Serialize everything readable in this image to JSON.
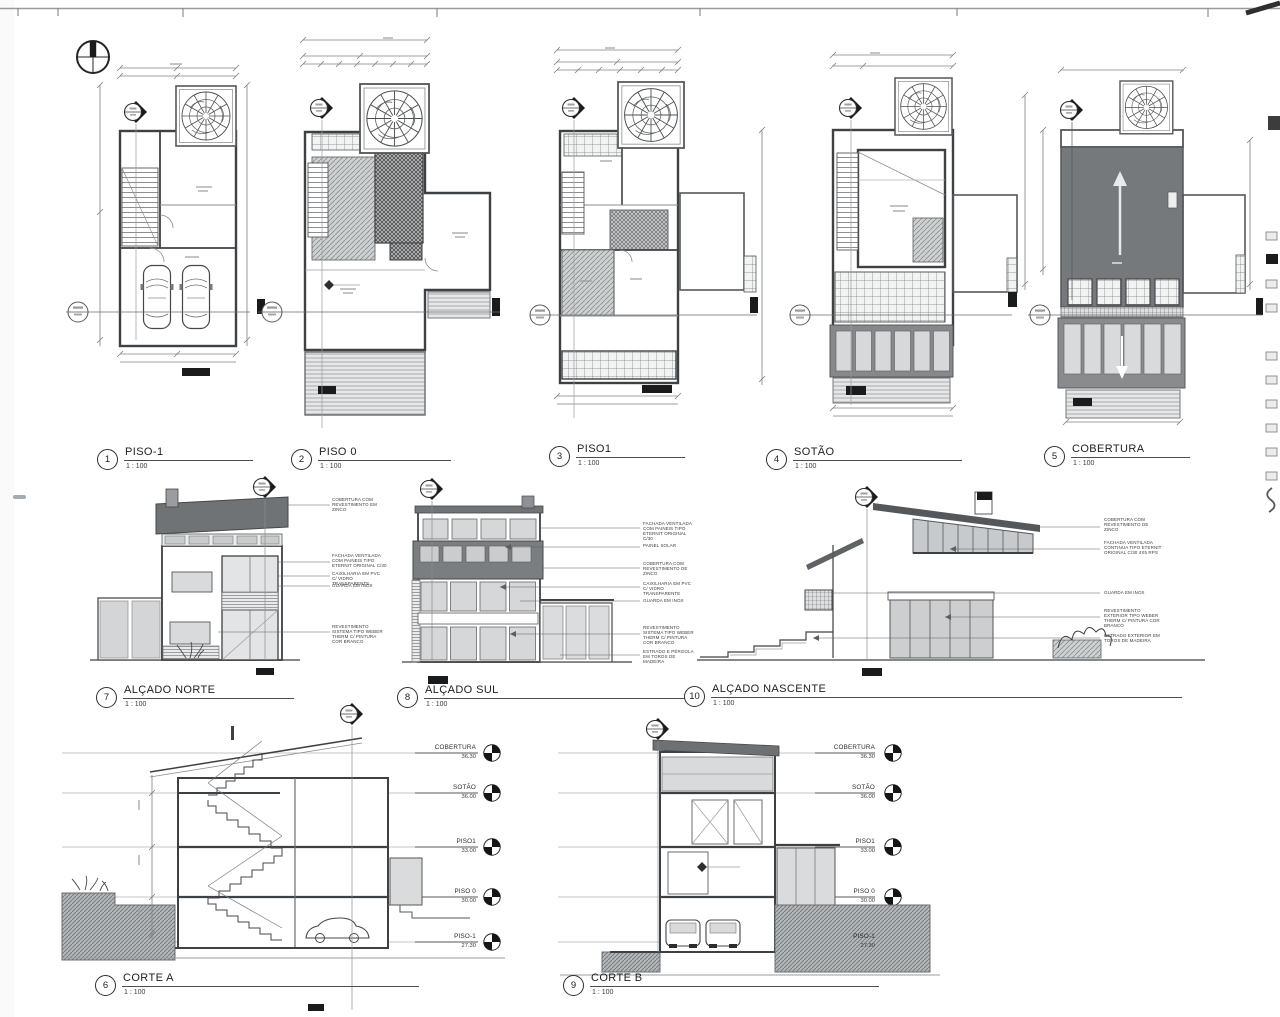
{
  "sheet": {
    "background": "#ffffff",
    "line_color": "#3e4144",
    "roof_gray": "#707477",
    "panel_gray": "#d5d7d8",
    "soil_gray": "#b3b6b8"
  },
  "views": {
    "piso_m1": {
      "num": "1",
      "title": "PISO-1",
      "scale": "1 : 100"
    },
    "piso_0": {
      "num": "2",
      "title": "PISO 0",
      "scale": "1 : 100"
    },
    "piso_1": {
      "num": "3",
      "title": "PISO1",
      "scale": "1 : 100"
    },
    "sotao": {
      "num": "4",
      "title": "SOTÃO",
      "scale": "1 : 100"
    },
    "cobertura": {
      "num": "5",
      "title": "COBERTURA",
      "scale": "1 : 100"
    },
    "corte_a": {
      "num": "6",
      "title": "CORTE A",
      "scale": "1 : 100"
    },
    "alcado_norte": {
      "num": "7",
      "title": "ALÇADO NORTE",
      "scale": "1 : 100"
    },
    "alcado_sul": {
      "num": "8",
      "title": "ALÇADO SUL",
      "scale": "1 : 100"
    },
    "corte_b": {
      "num": "9",
      "title": "CORTE B",
      "scale": "1 : 100"
    },
    "alcado_nascente": {
      "num": "10",
      "title": "ALÇADO NASCENTE",
      "scale": "1 : 100"
    }
  },
  "levels": [
    {
      "name": "COBERTURA",
      "elev": "36.30"
    },
    {
      "name": "SOTÃO",
      "elev": "36.00"
    },
    {
      "name": "PISO1",
      "elev": "33.00"
    },
    {
      "name": "PISO 0",
      "elev": "30.00"
    },
    {
      "name": "PISO-1",
      "elev": "27.30"
    }
  ],
  "annotations": {
    "norte": [
      "COBERTURA COM REVESTIMENTO EM ZINCO",
      "FACHADA VENTILADA COM PAINEIS TIPO ETERNIT ORIGINAL C/30",
      "CAIXILHARIA EM PVC C/ VIDRO TRANSPARENTE",
      "GUARDA EM INOX",
      "REVESTIMENTO SISTEMA TIPO WEBER THERM C/ PINTURA COR BRANCO"
    ],
    "sul": [
      "FACHADA VENTILADA COM PAINEIS TIPO ETERNIT ORIGINAL C/30",
      "PAINEL SOLAR",
      "COBERTURA COM REVESTIMENTO DE ZINCO",
      "CAIXILHARIA EM PVC C/ VIDRO TRANSPARENTE",
      "GUARDA EM INOX",
      "REVESTIMENTO SISTEMA TIPO WEBER THERM C/ PINTURA COR BRANCO",
      "ESTRADO E PÉRGOLA EM TOROS DE MADEIRA"
    ],
    "nascente": [
      "COBERTURA COM REVESTIMENTO DE ZINCO",
      "FACHADA VENTILADA CONTINUA TIPO ETERNIT ORIGINAL C/30 4X5 RPS",
      "GUARDA EM INOX",
      "REVESTIMENTO EXTERIOR TIPO WEBER THERM C/ PINTURA COR BRANCO",
      "ESTRADO EXTERIOR EM TOROS DE MADEIRA"
    ]
  }
}
